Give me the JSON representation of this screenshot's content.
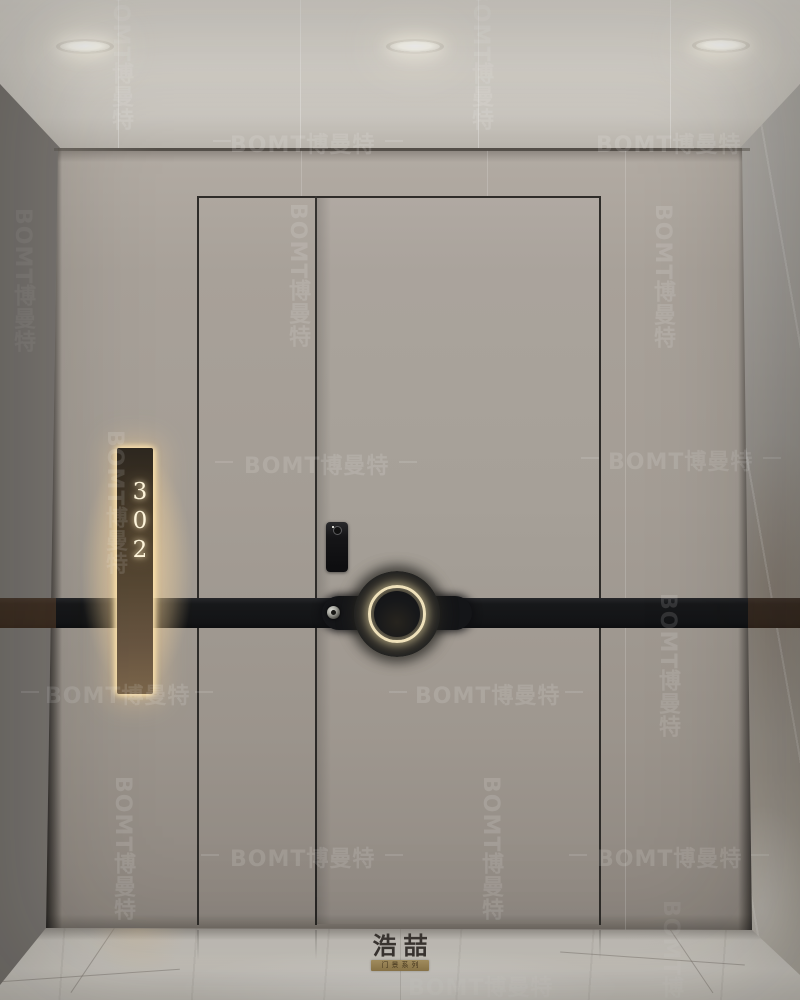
{
  "scene": {
    "subject": "apartment entrance door with illuminated room sign",
    "room_number": "302"
  },
  "watermark": {
    "text": "BOMT博曼特"
  },
  "door_sign": {
    "room_number": "302"
  },
  "brand_logo": {
    "name": "浩喆",
    "series": "门景系列"
  },
  "icons": {
    "ceiling_lights": "recessed-downlight",
    "lock": "smart-lock-keypad",
    "keyhole": "keyhole",
    "handle": "illuminated-ring-door-handle",
    "sign": "backlit-room-number-plate"
  },
  "colors": {
    "ceiling": "#d8d4cd",
    "wall": "#a49d95",
    "door": "#a7a098",
    "band": "#17181a",
    "marble_left": "#7a7672",
    "marble_right": "#a09c97",
    "bronze_sign": "#564733",
    "glow": "#ffe2ac",
    "floor": "#c9c5be",
    "logo_text": "#3c3733"
  }
}
